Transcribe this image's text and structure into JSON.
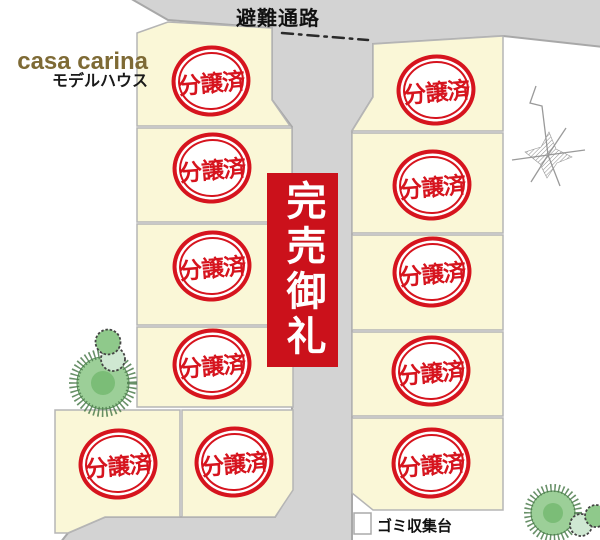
{
  "plan": {
    "road_label": "避難通路",
    "brand": {
      "name": "casa carina",
      "subtitle": "モデルハウス"
    },
    "banner_text": "完売御礼",
    "garbage_label": "ゴミ収集台",
    "lots": [
      {
        "label": "分譲済"
      },
      {
        "label": "分譲済"
      },
      {
        "label": "分譲済"
      },
      {
        "label": "分譲済"
      },
      {
        "label": "分譲済"
      },
      {
        "label": "分譲済"
      },
      {
        "label": "分譲済"
      },
      {
        "label": "分譲済"
      },
      {
        "label": "分譲済"
      },
      {
        "label": "分譲済"
      },
      {
        "label": "分譲済"
      }
    ],
    "colors": {
      "banner_red": "#cb111b",
      "stamp_red": "#d6141e",
      "brand_brown": "#7e6a35",
      "lot_fill": "#faf7d7",
      "lot_stroke": "#b5b5b5",
      "road_fill": "#d3d3d3",
      "road_stroke": "#a8a8a8",
      "tree_green": "#9ccf98",
      "tree_dark": "#4e7d4e",
      "tree_light": "#cfe8d2"
    }
  }
}
